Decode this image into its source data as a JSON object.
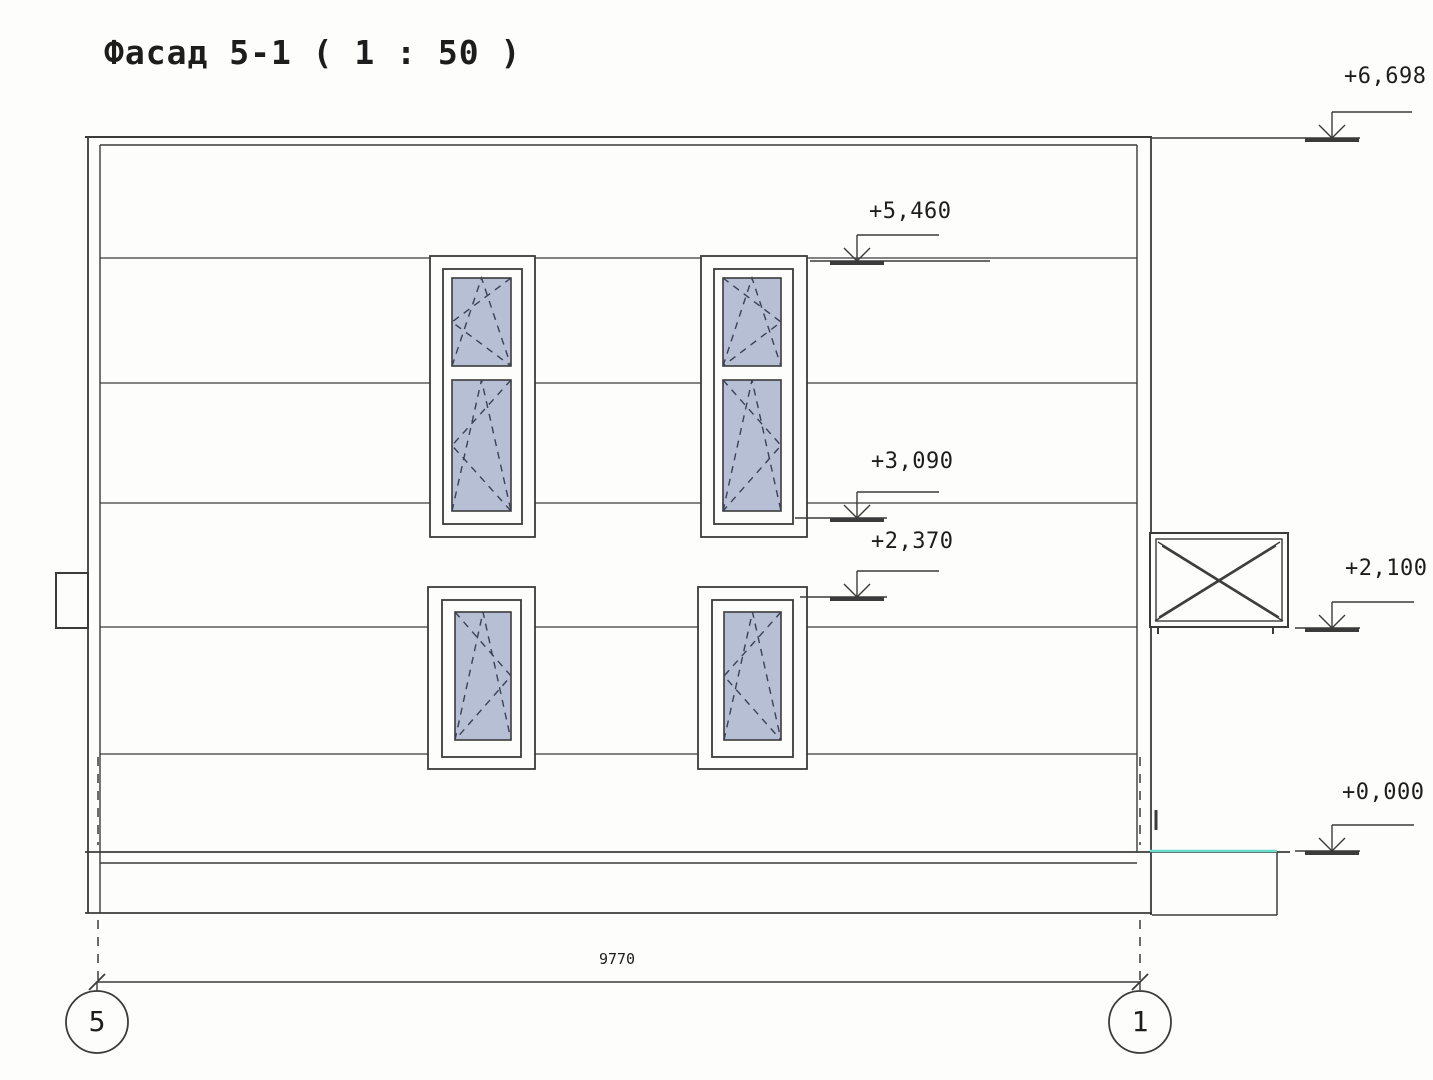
{
  "title": "Фасад 5-1 ( 1 : 50 )",
  "drawing": {
    "colors": {
      "line": "#3b3b3b",
      "glass": "#b7bfd5",
      "symbol": "#3a4154",
      "teal": "#6adcca",
      "text": "#1d1d1d"
    },
    "markers": [
      {
        "id": "level-6698",
        "label": "+6,698",
        "ax": 1332,
        "y": 138,
        "flag": 80,
        "level": [
          1152,
          1360
        ]
      },
      {
        "id": "level-5460",
        "label": "+5,460",
        "ax": 857,
        "y": 261,
        "flag": 82,
        "level": [
          810,
          990
        ]
      },
      {
        "id": "level-3090",
        "label": "+3,090",
        "ax": 857,
        "y": 518,
        "flag": 82,
        "level": [
          795,
          887
        ]
      },
      {
        "id": "level-2370",
        "label": "+2,370",
        "ax": 857,
        "y": 597,
        "flag": 82,
        "level": [
          800,
          887
        ]
      },
      {
        "id": "level-2100",
        "label": "+2,100",
        "ax": 1332,
        "y": 628,
        "flag": 82,
        "level": [
          1295,
          1360
        ]
      },
      {
        "id": "level-0000",
        "label": "+0,000",
        "ax": 1332,
        "y": 851,
        "flag": 82,
        "level": [
          1295,
          1360
        ]
      }
    ],
    "dimension": {
      "label": "9770",
      "x1": 97,
      "x2": 1140,
      "y": 982
    },
    "axes": [
      {
        "label": "5",
        "cx": 97,
        "cy": 1022,
        "r": 31
      },
      {
        "label": "1",
        "cx": 1140,
        "cy": 1022,
        "r": 31
      }
    ],
    "lines": [
      [
        85,
        137,
        1152,
        137,
        2
      ],
      [
        100,
        145,
        1137,
        145,
        1.4
      ],
      [
        88,
        137,
        88,
        913,
        1.8
      ],
      [
        100,
        145,
        100,
        913,
        1.4
      ],
      [
        1137,
        145,
        1137,
        852,
        1.4
      ],
      [
        1151,
        137,
        1151,
        915,
        1.8
      ],
      [
        100,
        258,
        1137,
        258,
        1.3
      ],
      [
        100,
        383,
        1137,
        383,
        1.3
      ],
      [
        100,
        503,
        1137,
        503,
        1.3
      ],
      [
        100,
        627,
        1137,
        627,
        1.3
      ],
      [
        100,
        754,
        1137,
        754,
        1.3
      ],
      [
        85,
        852,
        1290,
        852,
        1.7
      ],
      [
        100,
        863,
        1137,
        863,
        1.4
      ],
      [
        85,
        913,
        1152,
        913,
        1.8
      ],
      [
        1277,
        852,
        1277,
        915,
        1.5
      ],
      [
        1152,
        915,
        1277,
        915,
        1.5
      ],
      [
        97,
        982,
        97,
        991,
        1.4
      ],
      [
        1140,
        982,
        1140,
        991,
        1.4
      ]
    ],
    "thick": [
      [
        1156,
        810,
        1156,
        830,
        3
      ]
    ],
    "dashed": [
      [
        98,
        757,
        98,
        845
      ],
      [
        1140,
        757,
        1140,
        845
      ],
      [
        98,
        920,
        98,
        988
      ],
      [
        1140,
        920,
        1140,
        988
      ]
    ],
    "teal_line": [
      1150,
      851,
      1277,
      851
    ],
    "rects": [
      [
        56,
        573,
        32,
        55,
        2
      ]
    ],
    "windows": [
      {
        "name": "window-upper-left",
        "outer": [
          430,
          256,
          105,
          281
        ],
        "frame": [
          443,
          269,
          79,
          255
        ],
        "sashes": [
          {
            "glass": [
              452,
              278,
              59,
              88
            ],
            "turn": "left"
          },
          {
            "glass": [
              452,
              380,
              59,
              131
            ],
            "turn": "left"
          }
        ]
      },
      {
        "name": "window-upper-right",
        "outer": [
          701,
          256,
          106,
          281
        ],
        "frame": [
          714,
          269,
          79,
          255
        ],
        "sashes": [
          {
            "glass": [
              723,
              278,
              58,
              88
            ],
            "turn": "right"
          },
          {
            "glass": [
              723,
              380,
              58,
              131
            ],
            "turn": "right"
          }
        ]
      },
      {
        "name": "window-lower-left",
        "outer": [
          428,
          587,
          107,
          182
        ],
        "frame": [
          442,
          600,
          79,
          157
        ],
        "sashes": [
          {
            "glass": [
              455,
              612,
              56,
              128
            ],
            "turn": "right"
          }
        ]
      },
      {
        "name": "window-lower-right",
        "outer": [
          698,
          587,
          109,
          182
        ],
        "frame": [
          712,
          600,
          81,
          157
        ],
        "sashes": [
          {
            "glass": [
              724,
              612,
              57,
              128
            ],
            "turn": "left"
          }
        ]
      }
    ],
    "balcony": {
      "outer": [
        1150,
        533,
        138,
        94
      ],
      "inner": [
        1156,
        539,
        126,
        82
      ],
      "diagonals": [
        [
          1158,
          542,
          1279,
          617
        ],
        [
          1162,
          546,
          1283,
          621
        ],
        [
          1280,
          542,
          1159,
          617
        ],
        [
          1276,
          546,
          1155,
          621
        ]
      ],
      "feet": [
        [
          1158,
          627,
          1158,
          634
        ],
        [
          1273,
          627,
          1273,
          634
        ]
      ]
    }
  }
}
